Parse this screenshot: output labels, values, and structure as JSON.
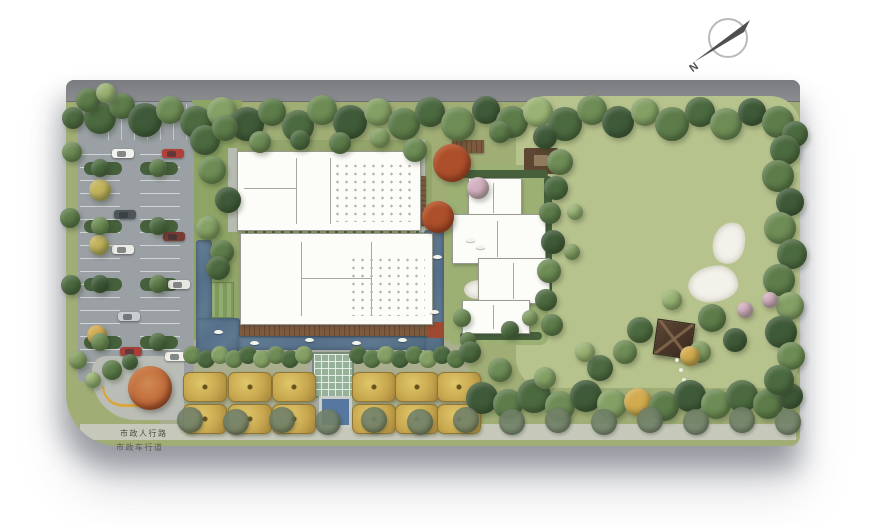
{
  "plan": {
    "labels": {
      "pedestrian": "市政人行路",
      "vehicular": "市政车行道",
      "north": "N"
    },
    "palette": {
      "board": "#a0ae76",
      "lawn": "#b7c38d",
      "parking": "#9aa0a3",
      "water": "#5e7890",
      "deck": "#6f4f36",
      "hedge": "#45603b",
      "gold_tree": "#c9a94f",
      "maple": "#ad4f2b",
      "sand": "#f2f1ea",
      "sidewalk": "#c6c8ba",
      "road": "#85868b"
    },
    "treeColors": {
      "d1": "#3f5a38",
      "d2": "#4c6a40",
      "m1": "#5d7c4a",
      "m2": "#6e8c55",
      "l1": "#85a065",
      "l2": "#9ab374",
      "y1": "#c2b45c",
      "y2": "#d2ab4e",
      "rd": "#ad4f2b",
      "pk": "#d4afc0",
      "st": "#72826a"
    },
    "ground": [
      {
        "n": "municipal-road-top",
        "x": 0,
        "y": 0,
        "w": 734,
        "h": 21,
        "cls": "roadtop"
      },
      {
        "n": "west-garden-strip",
        "x": 126,
        "y": 20,
        "w": 50,
        "h": 282,
        "c": "#8da465"
      },
      {
        "n": "central-courtyard-lawn",
        "x": 166,
        "y": 60,
        "w": 200,
        "h": 195,
        "c": "#93a56a",
        "r": 8
      },
      {
        "n": "orchard-plaza",
        "x": 94,
        "y": 260,
        "w": 310,
        "h": 92,
        "c": "#a9ae8e",
        "r": 6
      },
      {
        "n": "great-lawn",
        "x": 450,
        "y": 16,
        "w": 284,
        "h": 292,
        "c": "#b7c38d",
        "r": 30
      },
      {
        "n": "villa-garden",
        "x": 382,
        "y": 85,
        "w": 100,
        "h": 180,
        "c": "#9cb074",
        "r": 8
      },
      {
        "n": "parking-lot",
        "x": 12,
        "y": 22,
        "w": 116,
        "h": 280,
        "c": "#9aa0a3",
        "r": 4
      },
      {
        "n": "parking-stalls-top",
        "x": 30,
        "y": 24,
        "w": 96,
        "h": 36,
        "cls": "stallsV"
      },
      {
        "n": "parking-stalls-left",
        "x": 14,
        "y": 62,
        "w": 40,
        "h": 226,
        "cls": "stallsH"
      },
      {
        "n": "parking-stalls-right",
        "x": 74,
        "y": 62,
        "w": 40,
        "h": 226,
        "cls": "stallsH"
      },
      {
        "n": "parking-hedge",
        "x": 18,
        "y": 82,
        "w": 38,
        "h": 13,
        "c": "#45603b",
        "r": 7
      },
      {
        "n": "parking-hedge",
        "x": 74,
        "y": 82,
        "w": 38,
        "h": 13,
        "c": "#45603b",
        "r": 7
      },
      {
        "n": "parking-hedge",
        "x": 18,
        "y": 140,
        "w": 38,
        "h": 13,
        "c": "#45603b",
        "r": 7
      },
      {
        "n": "parking-hedge",
        "x": 74,
        "y": 140,
        "w": 38,
        "h": 13,
        "c": "#45603b",
        "r": 7
      },
      {
        "n": "parking-hedge",
        "x": 18,
        "y": 198,
        "w": 38,
        "h": 13,
        "c": "#45603b",
        "r": 7
      },
      {
        "n": "parking-hedge",
        "x": 74,
        "y": 198,
        "w": 38,
        "h": 13,
        "c": "#45603b",
        "r": 7
      },
      {
        "n": "parking-hedge",
        "x": 18,
        "y": 256,
        "w": 38,
        "h": 13,
        "c": "#45603b",
        "r": 7
      },
      {
        "n": "parking-hedge",
        "x": 74,
        "y": 256,
        "w": 38,
        "h": 13,
        "c": "#45603b",
        "r": 7
      },
      {
        "n": "sidewalk-band",
        "x": 14,
        "y": 344,
        "w": 716,
        "h": 16,
        "c": "#c6c8ba"
      },
      {
        "n": "entry-plaza",
        "x": 26,
        "y": 276,
        "w": 92,
        "h": 64,
        "c": "#b9bdb6",
        "r": "14px 6px 6px 44px"
      },
      {
        "n": "path-west",
        "x": 162,
        "y": 68,
        "w": 9,
        "h": 84,
        "c": "#b7bcb0"
      },
      {
        "n": "path-east",
        "x": 349,
        "y": 60,
        "w": 10,
        "h": 92,
        "c": "#b7bcb0"
      },
      {
        "n": "axis-path",
        "x": 242,
        "y": 260,
        "w": 42,
        "h": 88,
        "c": "#a7aba4"
      },
      {
        "n": "pergola-hedge-row",
        "x": 179,
        "y": 143,
        "w": 180,
        "h": 11,
        "cls": "pergola"
      },
      {
        "n": "courtyard-deck",
        "x": 326,
        "y": 96,
        "w": 34,
        "h": 50,
        "cls": "woodH"
      },
      {
        "n": "north-deck",
        "x": 386,
        "y": 60,
        "w": 32,
        "h": 13,
        "cls": "wood"
      },
      {
        "n": "roof-trellis",
        "x": 458,
        "y": 68,
        "w": 34,
        "h": 26,
        "c": "#5d4632",
        "r": 2
      },
      {
        "n": "roof-trellis-inner",
        "x": 468,
        "y": 75,
        "w": 14,
        "h": 11,
        "c": "#8f7c5e"
      },
      {
        "n": "villa-hedge-east",
        "x": 478,
        "y": 96,
        "w": 8,
        "h": 132,
        "c": "#45603b",
        "r": 4
      },
      {
        "n": "villa-hedge-north",
        "x": 390,
        "y": 90,
        "w": 92,
        "h": 8,
        "c": "#45603b",
        "r": 4
      },
      {
        "n": "villa-hedge-south",
        "x": 394,
        "y": 252,
        "w": 82,
        "h": 8,
        "c": "#45603b",
        "r": 4
      },
      {
        "n": "striped-planting-beds",
        "x": 132,
        "y": 202,
        "w": 34,
        "h": 34,
        "cls": "beds"
      },
      {
        "n": "pool-west-arm",
        "x": 130,
        "y": 160,
        "w": 16,
        "h": 96,
        "cls": "water"
      },
      {
        "n": "pool-west-pocket",
        "x": 130,
        "y": 238,
        "w": 44,
        "h": 34,
        "cls": "water"
      },
      {
        "n": "pool-south-arm",
        "x": 172,
        "y": 254,
        "w": 190,
        "h": 16,
        "cls": "water"
      },
      {
        "n": "water-channel-east",
        "x": 358,
        "y": 150,
        "w": 20,
        "h": 122,
        "cls": "water"
      },
      {
        "n": "pool-boardwalk",
        "x": 174,
        "y": 243,
        "w": 190,
        "h": 13,
        "cls": "wood"
      },
      {
        "n": "terracotta-planter",
        "x": 362,
        "y": 242,
        "w": 16,
        "h": 16,
        "c": "#9e4a30",
        "r": 2
      },
      {
        "n": "glass-canopy",
        "x": 246,
        "y": 272,
        "w": 38,
        "h": 42,
        "cls": "canopyglass"
      },
      {
        "n": "axis-water-square",
        "x": 253,
        "y": 316,
        "w": 27,
        "h": 26,
        "c": "#5577a0",
        "bd": "3px solid #c9cfc6"
      },
      {
        "n": "sand-feature",
        "x": 647,
        "y": 142,
        "w": 30,
        "h": 40,
        "cls": "sand",
        "rot": 15
      },
      {
        "n": "sand-feature",
        "x": 622,
        "y": 186,
        "w": 48,
        "h": 34,
        "cls": "sand",
        "rot": -8
      },
      {
        "n": "garden-pond",
        "x": 398,
        "y": 200,
        "w": 26,
        "h": 17,
        "cls": "sand"
      },
      {
        "n": "garden-pavilion",
        "x": 589,
        "y": 241,
        "w": 36,
        "h": 34,
        "cls": "pavilion",
        "rot": 8
      },
      {
        "n": "boulder-garden",
        "x": 196,
        "y": 206,
        "w": 26,
        "h": 18,
        "cls": "blob"
      },
      {
        "n": "boulder-garden",
        "x": 234,
        "y": 213,
        "w": 18,
        "h": 13,
        "cls": "blob"
      },
      {
        "n": "roof-equipment-row",
        "x": 278,
        "y": 74,
        "w": 72,
        "h": 7,
        "cls": "ticks"
      },
      {
        "n": "villa-court-pad",
        "x": 396,
        "y": 154,
        "w": 26,
        "h": 20,
        "c": "#8fa768",
        "r": 3
      }
    ],
    "buildings": [
      {
        "n": "clubhouse-north",
        "x": 171,
        "y": 71,
        "w": 182,
        "h": 78,
        "walls": [
          [
            58,
            6,
            1,
            66
          ],
          [
            92,
            6,
            1,
            66
          ],
          [
            6,
            36,
            52,
            1
          ]
        ],
        "dots": [
          95,
          10,
          80,
          60
        ]
      },
      {
        "n": "clubhouse-main",
        "x": 174,
        "y": 153,
        "w": 191,
        "h": 90,
        "walls": [
          [
            60,
            8,
            1,
            74
          ],
          [
            60,
            44,
            70,
            1
          ],
          [
            130,
            8,
            1,
            74
          ]
        ],
        "dots": [
          108,
          22,
          76,
          60
        ]
      },
      {
        "n": "villa-wing",
        "x": 402,
        "y": 98,
        "w": 52,
        "h": 38,
        "walls": [
          [
            24,
            4,
            1,
            30
          ]
        ]
      },
      {
        "n": "villa-wing",
        "x": 386,
        "y": 134,
        "w": 92,
        "h": 48,
        "walls": [
          [
            44,
            6,
            1,
            36
          ]
        ]
      },
      {
        "n": "villa-wing",
        "x": 412,
        "y": 178,
        "w": 70,
        "h": 44,
        "walls": [
          [
            34,
            4,
            1,
            36
          ]
        ]
      },
      {
        "n": "villa-wing",
        "x": 396,
        "y": 220,
        "w": 66,
        "h": 32,
        "walls": [
          [
            30,
            4,
            1,
            24
          ]
        ]
      }
    ],
    "cars": [
      [
        46,
        69,
        "#f2f2ee"
      ],
      [
        96,
        69,
        "#b04038"
      ],
      [
        48,
        130,
        "#4e5458"
      ],
      [
        46,
        165,
        "#eceae4"
      ],
      [
        97,
        152,
        "#7a3a34"
      ],
      [
        102,
        200,
        "#e8e8e2"
      ],
      [
        52,
        232,
        "#c9cdd1"
      ],
      [
        54,
        267,
        "#a8403a"
      ],
      [
        99,
        272,
        "#f0efe9"
      ]
    ],
    "boats": [
      [
        148,
        250
      ],
      [
        184,
        261
      ],
      [
        239,
        258
      ],
      [
        286,
        261
      ],
      [
        332,
        258
      ],
      [
        364,
        230
      ],
      [
        367,
        175
      ],
      [
        400,
        158
      ],
      [
        410,
        165
      ]
    ],
    "orchard": {
      "rows": [
        292,
        324
      ],
      "cols": [
        117,
        162,
        206,
        286,
        329,
        371
      ],
      "w": 42,
      "h": 28
    },
    "hedgerows": [
      {
        "x": 126,
        "y": 277,
        "count": 9,
        "dx": 14,
        "r": 9,
        "colors": [
          "m2",
          "d2",
          "l1"
        ]
      },
      {
        "x": 292,
        "y": 277,
        "count": 8,
        "dx": 14,
        "r": 9,
        "colors": [
          "d2",
          "m1",
          "l1"
        ]
      }
    ],
    "streetTrees": {
      "x": 124,
      "y": 341,
      "count": 14,
      "dx": 46,
      "r": 13,
      "colors": [
        "st"
      ],
      "cls": "street"
    },
    "trees": [
      [
        34,
        38,
        16,
        "d2"
      ],
      [
        56,
        26,
        13,
        "m1"
      ],
      [
        79,
        40,
        17,
        "d1"
      ],
      [
        104,
        30,
        14,
        "m2"
      ],
      [
        130,
        42,
        16,
        "d2"
      ],
      [
        156,
        32,
        15,
        "l1"
      ],
      [
        181,
        44,
        17,
        "d1"
      ],
      [
        206,
        32,
        14,
        "m1"
      ],
      [
        232,
        46,
        16,
        "d2"
      ],
      [
        256,
        30,
        15,
        "m2"
      ],
      [
        284,
        42,
        17,
        "d1"
      ],
      [
        312,
        32,
        14,
        "l1"
      ],
      [
        338,
        44,
        16,
        "m1"
      ],
      [
        364,
        32,
        15,
        "d2"
      ],
      [
        392,
        44,
        17,
        "m2"
      ],
      [
        420,
        30,
        14,
        "d1"
      ],
      [
        446,
        42,
        16,
        "m1"
      ],
      [
        472,
        32,
        15,
        "l2"
      ],
      [
        499,
        44,
        17,
        "d2"
      ],
      [
        526,
        30,
        15,
        "m2"
      ],
      [
        552,
        42,
        16,
        "d1"
      ],
      [
        579,
        32,
        14,
        "l1"
      ],
      [
        606,
        44,
        17,
        "m1"
      ],
      [
        634,
        32,
        15,
        "d2"
      ],
      [
        660,
        44,
        16,
        "m2"
      ],
      [
        686,
        32,
        14,
        "d1"
      ],
      [
        712,
        42,
        16,
        "m1"
      ],
      [
        729,
        54,
        13,
        "d2"
      ],
      [
        22,
        20,
        12,
        "m1"
      ],
      [
        40,
        13,
        10,
        "l2"
      ],
      [
        7,
        38,
        11,
        "d2"
      ],
      [
        34,
        110,
        11,
        "y1"
      ],
      [
        33,
        165,
        10,
        "y1"
      ],
      [
        31,
        255,
        10,
        "y2"
      ],
      [
        6,
        72,
        10,
        "m2"
      ],
      [
        4,
        138,
        10,
        "m1"
      ],
      [
        5,
        205,
        10,
        "d2"
      ],
      [
        12,
        280,
        9,
        "l1"
      ],
      [
        139,
        60,
        15,
        "d2"
      ],
      [
        159,
        48,
        13,
        "m1"
      ],
      [
        146,
        90,
        14,
        "m2"
      ],
      [
        162,
        120,
        13,
        "d1"
      ],
      [
        142,
        148,
        12,
        "l1"
      ],
      [
        156,
        172,
        12,
        "m1"
      ],
      [
        152,
        188,
        12,
        "d2"
      ],
      [
        194,
        62,
        11,
        "m2"
      ],
      [
        234,
        60,
        10,
        "d2"
      ],
      [
        274,
        63,
        11,
        "m1"
      ],
      [
        314,
        58,
        10,
        "l1"
      ],
      [
        349,
        70,
        12,
        "m2"
      ],
      [
        434,
        52,
        11,
        "m1"
      ],
      [
        479,
        57,
        12,
        "d1"
      ],
      [
        494,
        82,
        13,
        "m2"
      ],
      [
        490,
        108,
        12,
        "d2"
      ],
      [
        484,
        133,
        11,
        "m1"
      ],
      [
        487,
        162,
        12,
        "d1"
      ],
      [
        483,
        191,
        12,
        "m2"
      ],
      [
        480,
        220,
        11,
        "d2"
      ],
      [
        486,
        245,
        11,
        "m1"
      ],
      [
        509,
        132,
        8,
        "l2"
      ],
      [
        506,
        172,
        8,
        "l1"
      ],
      [
        574,
        250,
        13,
        "d2"
      ],
      [
        646,
        238,
        14,
        "m1"
      ],
      [
        669,
        260,
        12,
        "d1"
      ],
      [
        634,
        272,
        11,
        "l1"
      ],
      [
        606,
        220,
        10,
        "l2"
      ],
      [
        559,
        272,
        12,
        "m2"
      ],
      [
        624,
        276,
        10,
        "y2"
      ],
      [
        679,
        230,
        8,
        "pk"
      ],
      [
        416,
        318,
        16,
        "d1"
      ],
      [
        442,
        324,
        15,
        "m1"
      ],
      [
        468,
        316,
        17,
        "d2"
      ],
      [
        494,
        326,
        15,
        "m2"
      ],
      [
        520,
        316,
        16,
        "d1"
      ],
      [
        546,
        324,
        15,
        "l1"
      ],
      [
        572,
        322,
        14,
        "y2"
      ],
      [
        598,
        326,
        15,
        "m1"
      ],
      [
        624,
        316,
        16,
        "d1"
      ],
      [
        650,
        324,
        15,
        "m2"
      ],
      [
        676,
        316,
        16,
        "d2"
      ],
      [
        702,
        324,
        15,
        "m1"
      ],
      [
        724,
        316,
        13,
        "d1"
      ],
      [
        434,
        290,
        12,
        "m2"
      ],
      [
        479,
        298,
        11,
        "l1"
      ],
      [
        534,
        288,
        13,
        "d2"
      ],
      [
        519,
        272,
        10,
        "l2"
      ],
      [
        719,
        70,
        15,
        "d2"
      ],
      [
        712,
        96,
        16,
        "m1"
      ],
      [
        724,
        122,
        14,
        "d1"
      ],
      [
        714,
        148,
        16,
        "m2"
      ],
      [
        726,
        174,
        15,
        "d2"
      ],
      [
        713,
        200,
        16,
        "m1"
      ],
      [
        724,
        226,
        14,
        "l1"
      ],
      [
        715,
        252,
        16,
        "d1"
      ],
      [
        725,
        276,
        14,
        "m2"
      ],
      [
        713,
        300,
        15,
        "d2"
      ],
      [
        704,
        220,
        8,
        "pk"
      ],
      [
        386,
        83,
        19,
        "rd"
      ],
      [
        372,
        137,
        16,
        "rd"
      ],
      [
        412,
        108,
        11,
        "pk"
      ],
      [
        46,
        290,
        10,
        "m1"
      ],
      [
        27,
        300,
        8,
        "l2"
      ],
      [
        64,
        282,
        8,
        "d2"
      ],
      [
        34,
        88,
        9,
        "d2"
      ],
      [
        92,
        88,
        9,
        "m1"
      ],
      [
        34,
        146,
        9,
        "m2"
      ],
      [
        92,
        146,
        9,
        "d2"
      ],
      [
        34,
        204,
        9,
        "d1"
      ],
      [
        92,
        204,
        9,
        "m1"
      ],
      [
        34,
        262,
        9,
        "m2"
      ],
      [
        92,
        262,
        9,
        "d2"
      ],
      [
        396,
        238,
        9,
        "m2"
      ],
      [
        444,
        250,
        9,
        "d2"
      ],
      [
        464,
        238,
        8,
        "l1"
      ],
      [
        402,
        260,
        8,
        "m1"
      ],
      [
        404,
        272,
        11,
        "d2"
      ],
      [
        83,
        305,
        12,
        "rd"
      ]
    ],
    "entryTree": {
      "x": 84,
      "y": 308,
      "r": 22,
      "color": "#bf6a3a"
    },
    "steppingStones": [
      [
        609,
        278
      ],
      [
        613,
        288
      ],
      [
        616,
        298
      ],
      [
        612,
        308
      ],
      [
        607,
        316
      ],
      [
        603,
        324
      ]
    ]
  }
}
